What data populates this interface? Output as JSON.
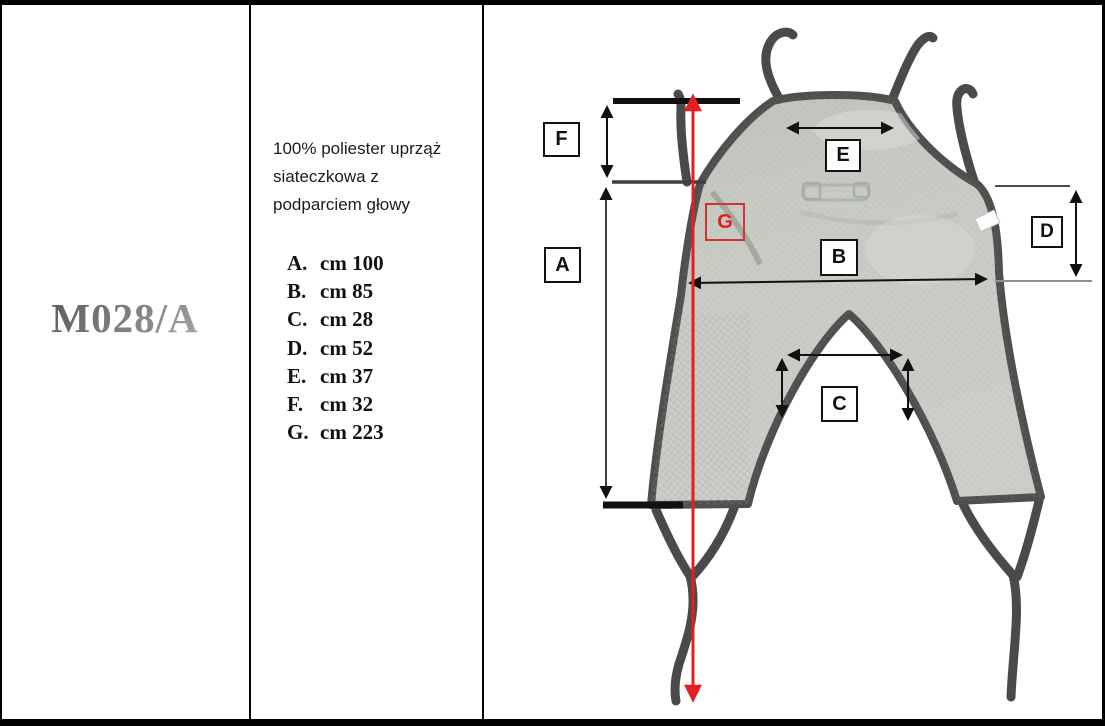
{
  "product": {
    "code": "M028/A"
  },
  "description": {
    "lines": [
      "100% poliester uprząż",
      "siateczkowa z",
      "podparciem głowy"
    ]
  },
  "measurements": [
    {
      "label": "A.",
      "value": "cm 100"
    },
    {
      "label": "B.",
      "value": "cm 85"
    },
    {
      "label": "C.",
      "value": "cm 28"
    },
    {
      "label": "D.",
      "value": "cm 52"
    },
    {
      "label": "E.",
      "value": "cm 37"
    },
    {
      "label": "F.",
      "value": "cm 32"
    },
    {
      "label": "G.",
      "value": "cm 223"
    }
  ],
  "diagram": {
    "labels": [
      {
        "id": "F",
        "text": "F"
      },
      {
        "id": "A",
        "text": "A"
      },
      {
        "id": "E",
        "text": "E"
      },
      {
        "id": "G",
        "text": "G"
      },
      {
        "id": "B",
        "text": "B"
      },
      {
        "id": "D",
        "text": "D"
      },
      {
        "id": "C",
        "text": "C"
      }
    ],
    "colors": {
      "dimension_line": "#111111",
      "highlight_red": "#e2201f",
      "fabric": "#c8cbc4",
      "strap": "#4e4e4e"
    }
  }
}
